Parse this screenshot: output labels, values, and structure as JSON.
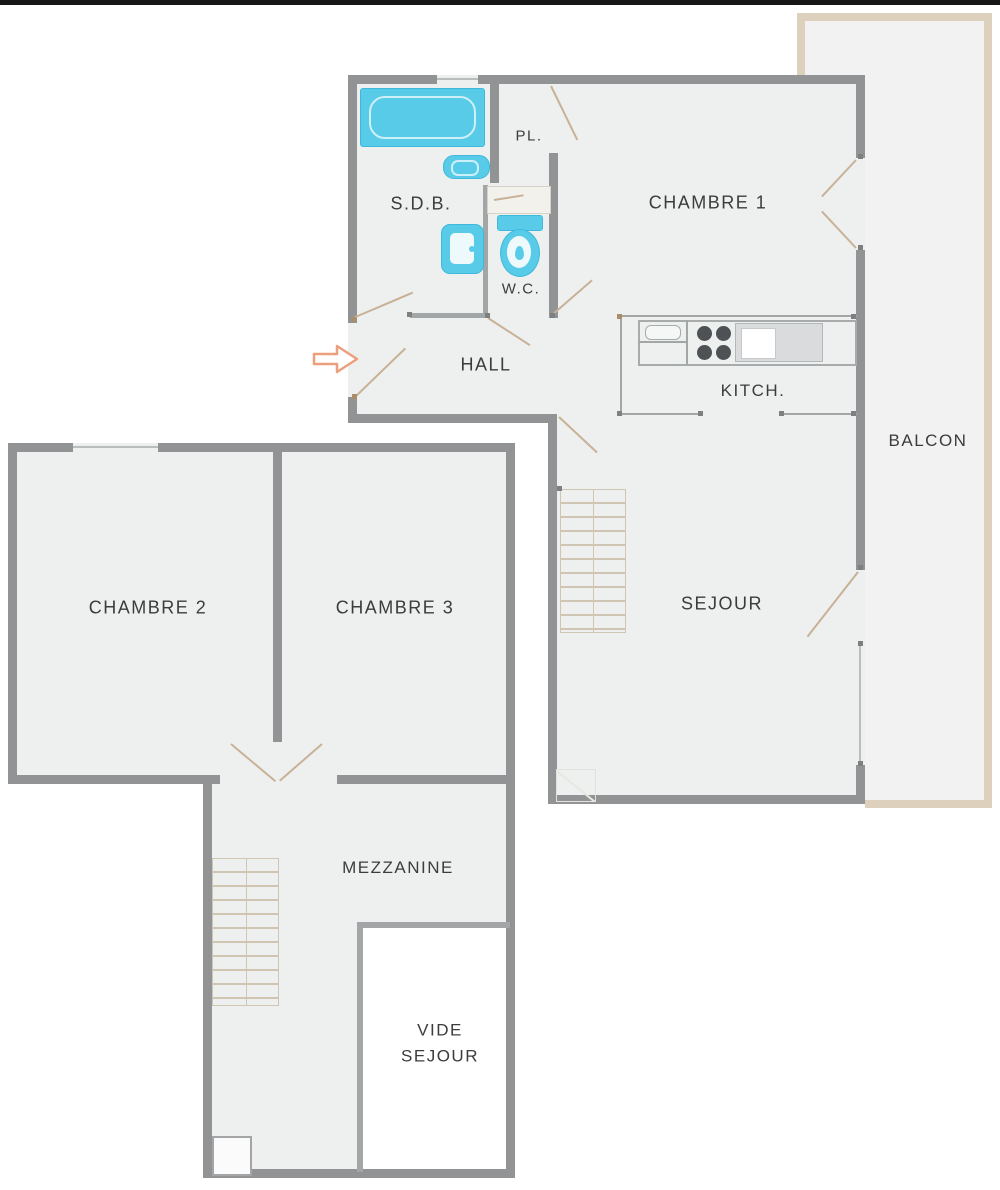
{
  "plan": {
    "title": "apartment-floor-plan",
    "rooms": {
      "sdb": "S.D.B.",
      "pl": "PL.",
      "wc": "W.C.",
      "hall": "HALL",
      "kitchen": "KITCH.",
      "chambre1": "CHAMBRE 1",
      "balcony": "BALCON",
      "sejour": "SEJOUR",
      "chambre2": "CHAMBRE 2",
      "chambre3": "CHAMBRE 3",
      "mezzanine": "MEZZANINE",
      "vide_sejour_line1": "VIDE",
      "vide_sejour_line2": "SEJOUR"
    },
    "icons": {
      "entrance_arrow": "block-arrow-right"
    },
    "palette": {
      "wall": "#919394",
      "floor": "#eef0ef",
      "balcony_band": "#ddd0bd",
      "fixture_cyan": "#58cbe8",
      "door_swing": "#c8b196",
      "arrow_outline": "#eb9f7d",
      "label_text": "#3c3c3c",
      "top_bar": "#161616"
    }
  }
}
